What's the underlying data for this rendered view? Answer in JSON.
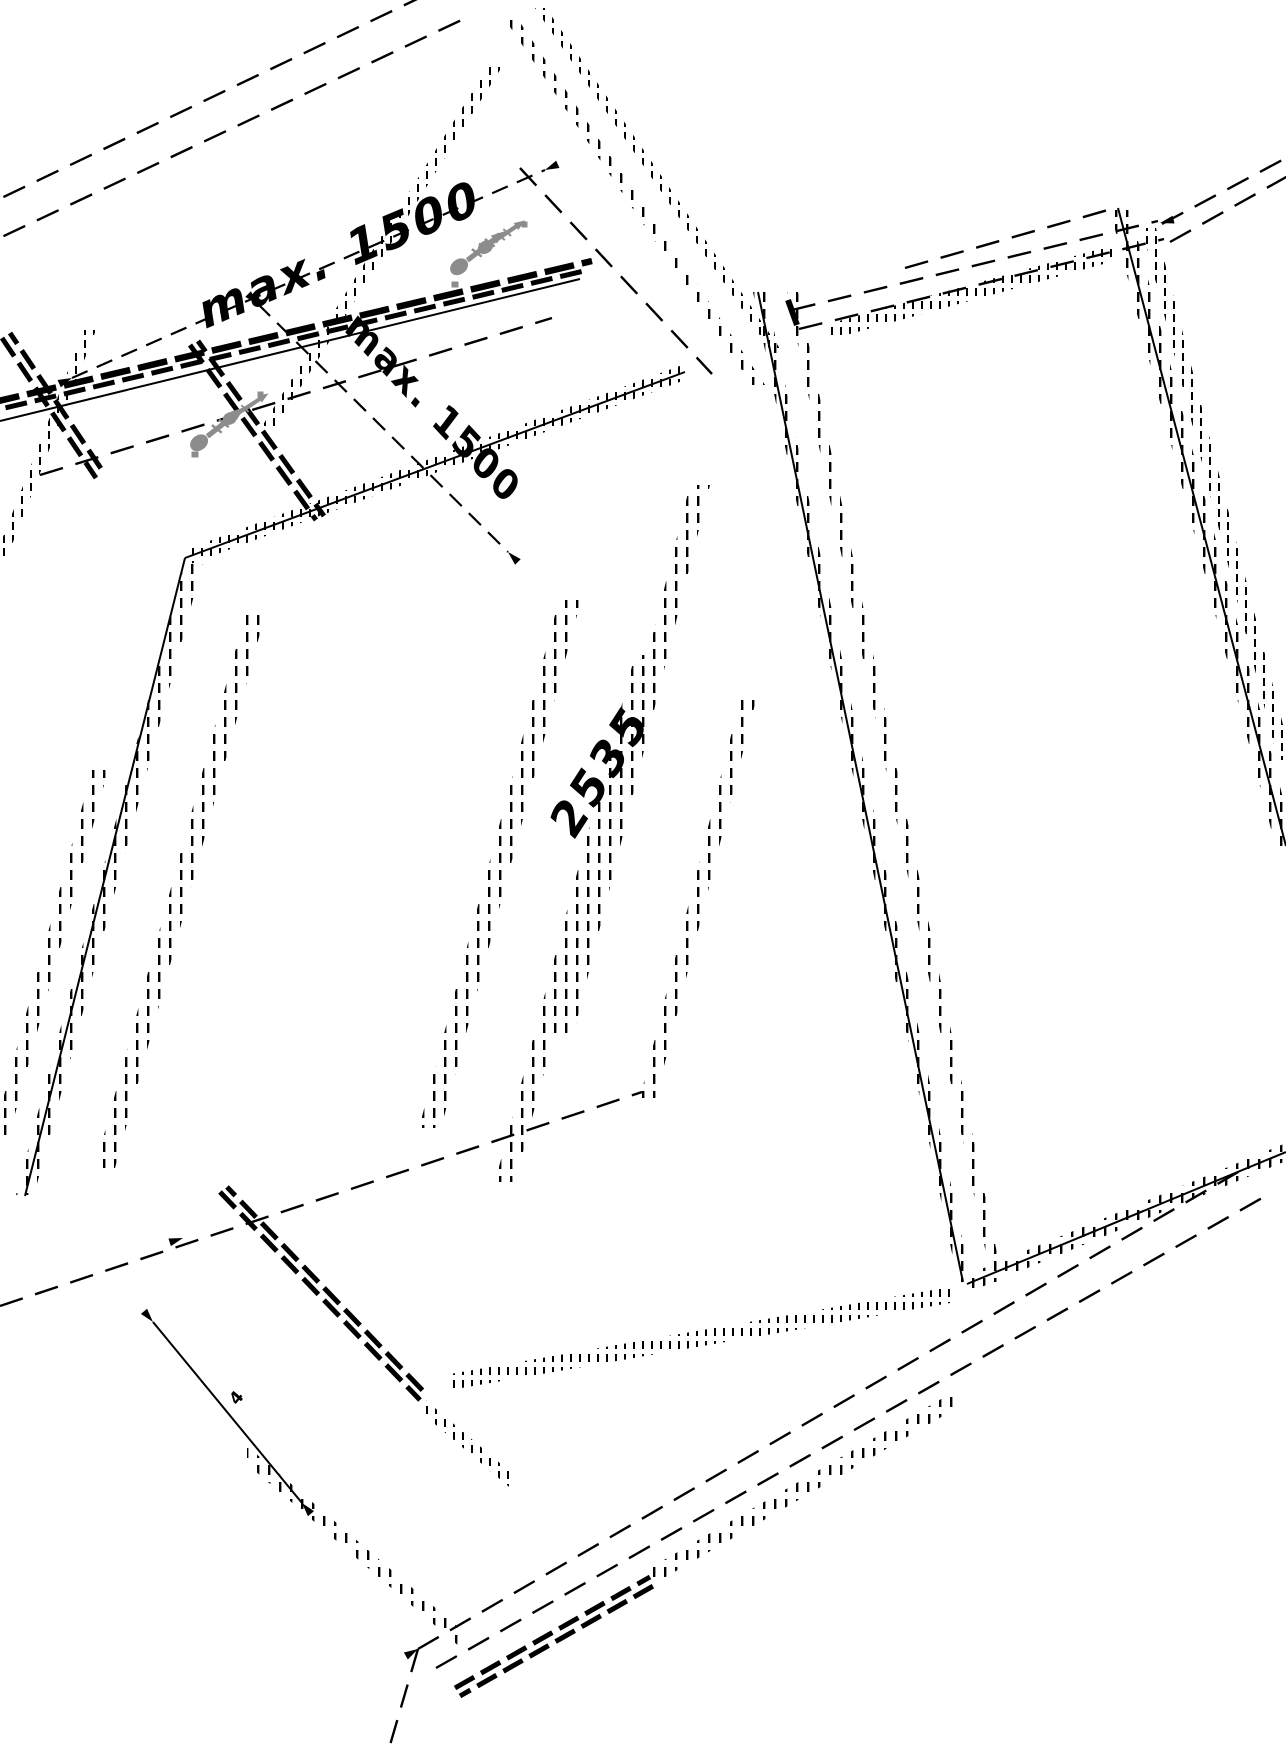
{
  "labels": {
    "dim_top": "max. 1500",
    "dim_cross": "max. 1500",
    "dim_length": "2535",
    "dim_small": "4"
  },
  "icons": {
    "screw": "screw-icon",
    "arrowhead": "arrowhead-icon"
  },
  "colors": {
    "line": "#000000",
    "screw_gray": "#8c8c8c",
    "background": "#ffffff"
  }
}
